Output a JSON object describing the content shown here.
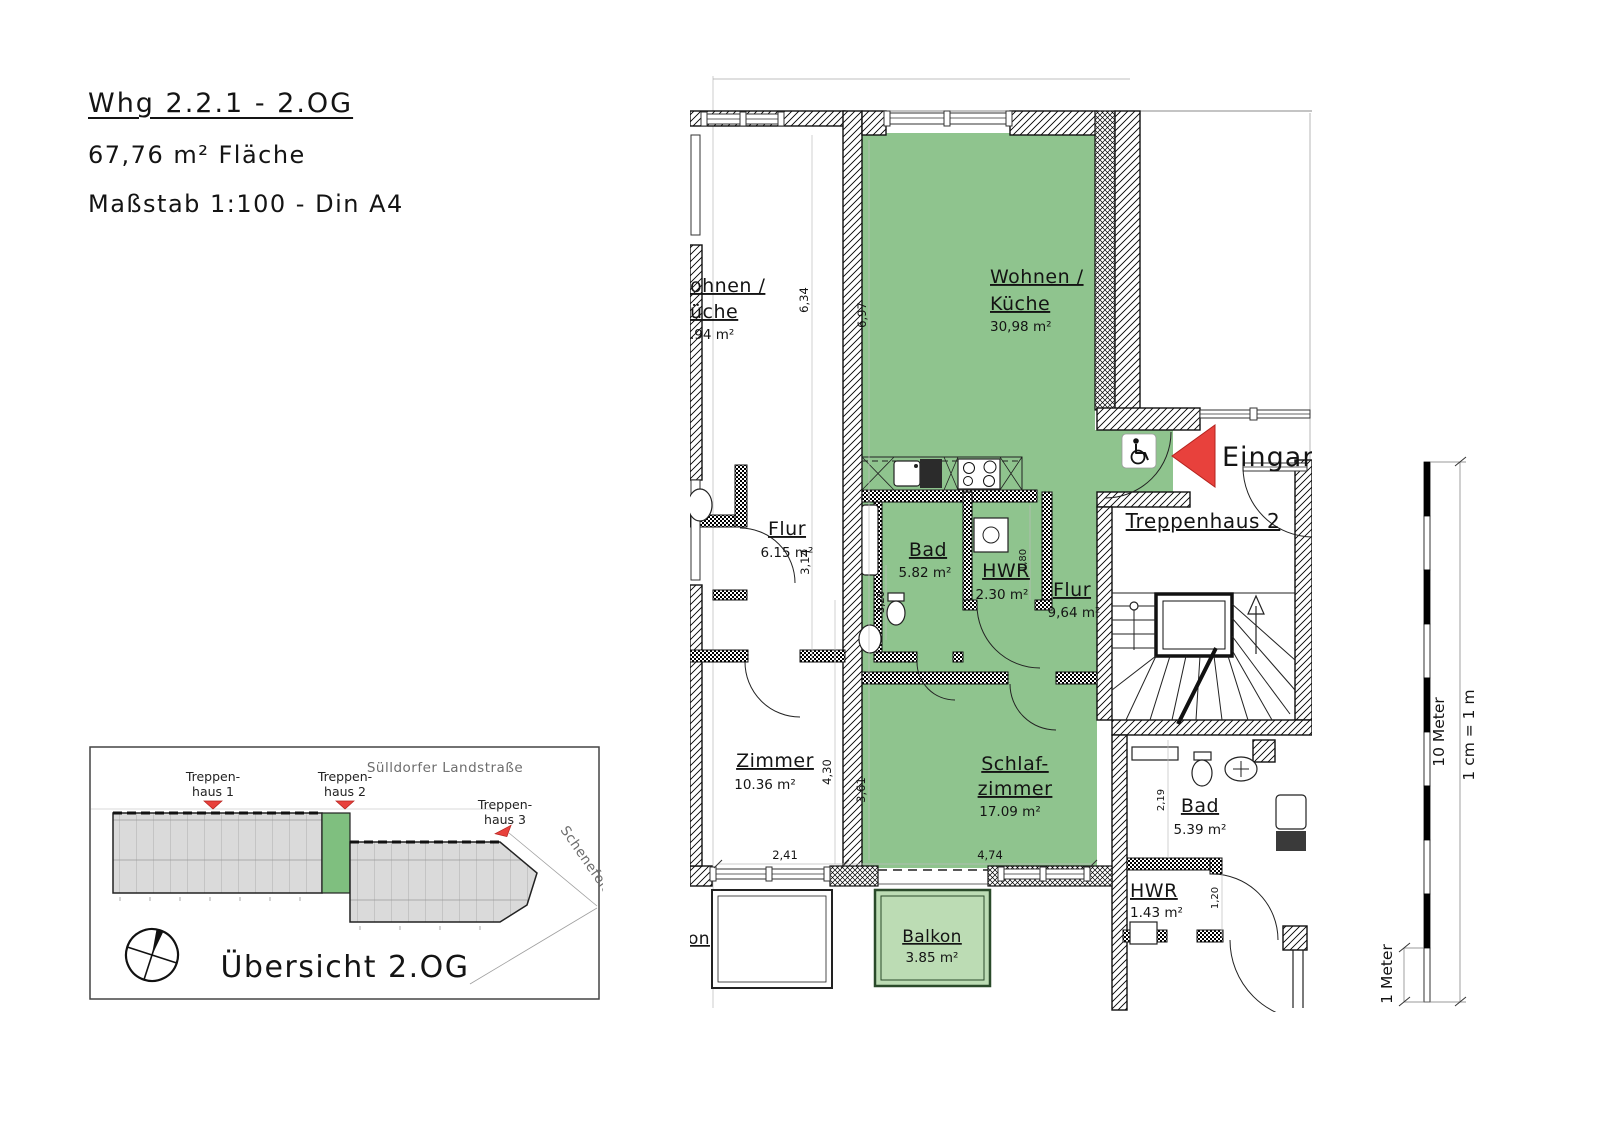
{
  "title_block": {
    "line1": "Whg 2.2.1 - 2.OG",
    "line2": "67,76 m² Fläche",
    "line3": "Maßstab 1:100 - Din A4"
  },
  "plan": {
    "entrance_label": "Eingang",
    "colors": {
      "unit_green": "#8fc48e",
      "balcony_green": "#bcdcb4",
      "entrance_red": "#e8413c"
    },
    "rooms": {
      "wohnen": {
        "l1": "Wohnen /",
        "l2": "Küche",
        "area": "30,98 m²"
      },
      "schlaf": {
        "l1": "Schlaf-",
        "l2": "zimmer",
        "area": "17.09 m²"
      },
      "bad": {
        "l1": "Bad",
        "area": "5.82 m²"
      },
      "hwr": {
        "l1": "HWR",
        "area": "2.30 m²"
      },
      "flur": {
        "l1": "Flur",
        "area": "9,64 m²"
      },
      "balkon": {
        "l1": "Balkon",
        "area": "3.85 m²"
      },
      "treppenhaus2": {
        "l1": "Treppenhaus 2"
      },
      "bad2": {
        "l1": "Bad",
        "area": "5.39 m²"
      },
      "hwr2": {
        "l1": "HWR",
        "area": "1.43 m²"
      },
      "nb_wohnen": {
        "l1": "ohnen /",
        "l2": "üche",
        "area": ".94 m²"
      },
      "nb_flur": {
        "l1": "Flur",
        "area": "6.15 m²"
      },
      "nb_zimmer": {
        "l1": "Zimmer",
        "area": "10.36 m²"
      },
      "nb_balkon": {
        "l1": "on"
      }
    },
    "dims": {
      "a": "6,34",
      "b": "6,97",
      "c": "3,14",
      "d": "3,20",
      "e": "1,80",
      "f": "4,30",
      "g": "3,61",
      "h": "2,41",
      "i": "4,74",
      "j": "2,19",
      "k": "1,20"
    }
  },
  "overview": {
    "title": "Übersicht 2.OG",
    "street_top": "Sülldorfer Landstraße",
    "street_right": "Schenefelder Landstr.",
    "marker_color": "#e8413c",
    "stairs": [
      {
        "l1": "Treppen-",
        "l2": "haus 1"
      },
      {
        "l1": "Treppen-",
        "l2": "haus 2"
      },
      {
        "l1": "Treppen-",
        "l2": "haus 3"
      }
    ]
  },
  "scalebar": {
    "label_total": "10 Meter",
    "label_scale": "1 cm = 1 m",
    "label_unit": "1 Meter"
  }
}
